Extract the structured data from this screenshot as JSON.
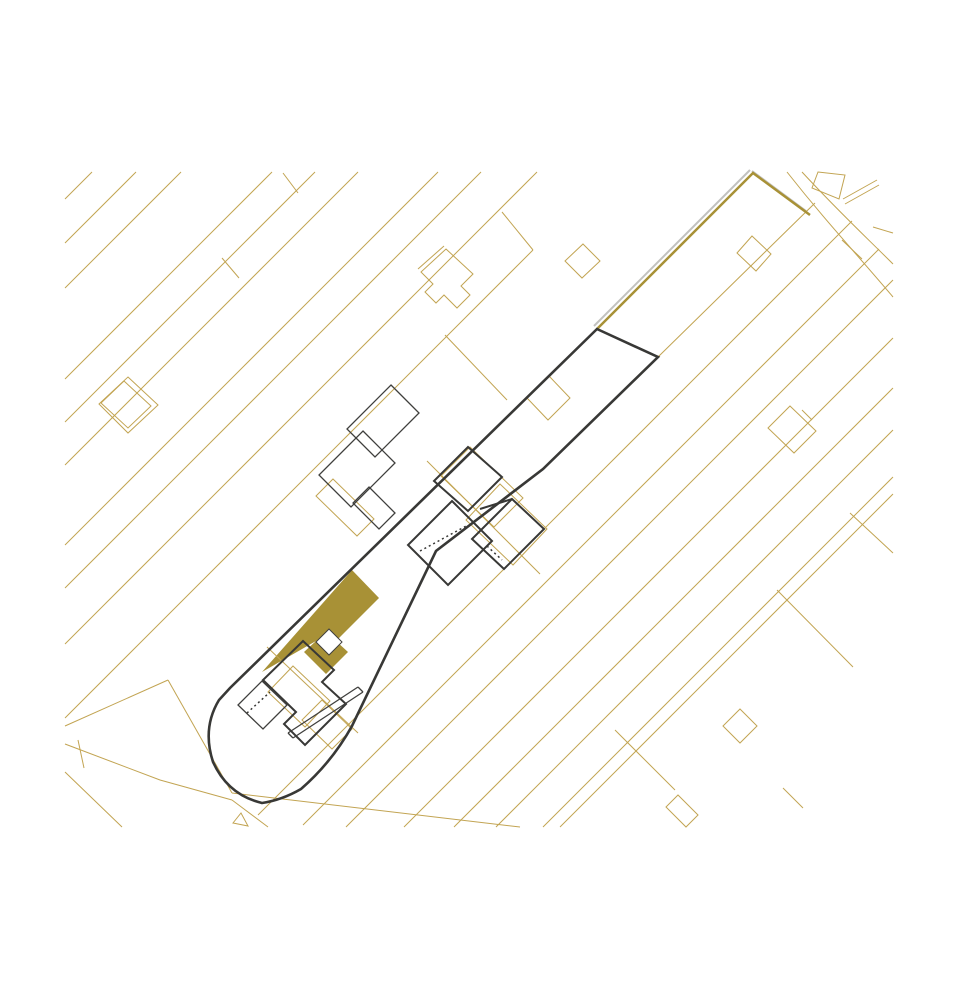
{
  "document": {
    "kind": "architectural-site-plan",
    "description": "Cadastral site plan with diagonal ribbon parcels, black site boundary, existing buildings and gold highlighted new building footprint"
  },
  "drawing": {
    "canvas": {
      "width": 960,
      "height": 1000,
      "background": "#ffffff"
    },
    "clip": {
      "x": 63,
      "y": 168,
      "w": 832,
      "h": 662
    },
    "colors": {
      "gold": "#C2A452",
      "goldDark": "#A89136",
      "fillGold": "#A89136",
      "black": "#383836",
      "thinBlack": "#3F3F3D",
      "shadow": "#8F8F8B",
      "white": "#ffffff"
    },
    "layers": [
      {
        "name": "highlight-building-fill",
        "fill": "fillGold",
        "stroke": "none",
        "width": 0,
        "paths": [
          "M262,672 L352,570 L379,598 L336,641 L348,652 L326,674 L304,652 L316,641 Z"
        ]
      },
      {
        "name": "highlight-notch",
        "fill": "white",
        "stroke": "thinBlack",
        "width": 1,
        "paths": [
          "M329,629 L342,642 L329,655 L316,642 Z"
        ]
      },
      {
        "name": "parcel-lines-upper-left",
        "stroke": "gold",
        "width": 1,
        "paths": [
          "M92,172 L65,199",
          "M136,172 L65,243",
          "M181,172 L65,288",
          "M272,172 L65,379",
          "M315,172 L65,422",
          "M358,172 L65,465",
          "M438,172 L65,545",
          "M481,172 L65,588",
          "M537,172 L65,644",
          "M533,250 L65,718"
        ]
      },
      {
        "name": "parcel-lines-lower-right",
        "stroke": "gold",
        "width": 1,
        "paths": [
          "M852,221 L258,815",
          "M879,249 L303,825",
          "M893,280 L346,827",
          "M893,338 L404,827",
          "M893,388 L454,827",
          "M893,430 L496,827",
          "M893,477 L543,827",
          "M893,494 L560,827"
        ]
      },
      {
        "name": "parcel-cross-connectors",
        "stroke": "gold",
        "width": 1,
        "paths": [
          "M283,173 L298,193",
          "M222,258 L239,278",
          "M502,212 L533,250",
          "M445,335 L507,400",
          "M873,227 L893,233",
          "M850,513 L893,553",
          "M777,590 L853,667",
          "M615,730 L675,790",
          "M783,788 L803,808"
        ]
      },
      {
        "name": "road-fork-bottom-left",
        "stroke": "gold",
        "width": 1,
        "paths": [
          "M65,726 L168,680",
          "M168,680 L232,793",
          "M65,744 L160,780 L232,800",
          "M65,772 L122,827",
          "M78,740 L84,768",
          "M232,793 L520,827",
          "M232,800 L268,827",
          "M233,823 L248,826 L241,813 Z"
        ]
      },
      {
        "name": "road-top-right",
        "stroke": "gold",
        "width": 1,
        "paths": [
          "M787,172 C828,224 855,252 893,297",
          "M802,172 C840,213 865,236 893,264",
          "M818,172 L845,175 L839,199 L812,188 Z",
          "M843,199 L877,180",
          "M845,204 L879,185",
          "M842,240 L862,259",
          "M658,357 L815,203"
        ]
      },
      {
        "name": "neighbor-small-buildings",
        "stroke": "gold",
        "width": 1,
        "paths": [
          "M583,244 L600,261 L582,278 L565,261 Z",
          "M549,376 L570,398 L548,420 L527,398 Z",
          "M752,236 L771,254 L756,271 L737,253 Z",
          "M790,406 L816,431 L794,453 L768,428 Z",
          "M802,410 L812,420",
          "M740,709 L757,726 L740,743 L723,726 Z",
          "M678,795 L698,815 L686,827 L666,807 Z",
          "M128,377 L158,405 L128,433 L99,404 Z",
          "M124,381 L151,406 L128,428 L101,403 Z",
          "M446,249 L473,274 L461,286 L470,295 L457,308 L444,295 L436,303 L425,292 L433,284 L421,272 Z",
          "M418,269 L444,246"
        ]
      },
      {
        "name": "old-footprint-overlays",
        "stroke": "gold",
        "width": 1,
        "paths": [
          "M470,447 L523,498 L494,527 L441,476 Z",
          "M500,484 L547,529 L513,565 L466,520 Z",
          "M427,461 L540,574",
          "M333,479 L374,519 L357,536 L316,496 Z",
          "M267,647 L358,733",
          "M293,666 L330,701 L305,727 L268,692 Z",
          "M322,700 L352,729 L332,749 L302,720 Z"
        ]
      },
      {
        "name": "parcel-shadow",
        "stroke": "shadow",
        "width": 2,
        "opacity": 0.55,
        "paths": [
          "M594,326 L750,170",
          "M752,171 L806,211"
        ]
      },
      {
        "name": "emphasized-parcel-edge",
        "stroke": "goldDark",
        "width": 2.5,
        "paths": [
          "M597,329 L753,173 L810,215"
        ]
      },
      {
        "name": "site-boundary",
        "stroke": "black",
        "width": 2.6,
        "paths": [
          "M597,329 L658,357 L543,469 L436,551 L352,726 Q332,762 301,789 Q282,800 262,803 Q228,795 213,762 Q202,728 219,700 L230,688 Z"
        ]
      },
      {
        "name": "neighbor-building-north",
        "stroke": "thinBlack",
        "width": 1.3,
        "paths": [
          "M391,385 L419,413 L375,457 L347,429 Z",
          "M363,431 L395,463 L351,507 L319,475 Z",
          "M369,487 L395,513 L379,529 L353,503 Z"
        ]
      },
      {
        "name": "existing-building-middle",
        "stroke": "black",
        "width": 2,
        "paths": [
          "M468,447 L502,477 L468,511 L434,481 Z",
          "M512,499 L544,529 L504,569 L472,539 Z",
          "M452,501 L492,541 L448,585 L408,545 Z",
          "M480,509 L512,499"
        ]
      },
      {
        "name": "existing-building-middle-dashed",
        "stroke": "black",
        "width": 1.5,
        "dash": "2 3",
        "paths": [
          "M420,551 L468,525",
          "M487,546 L502,560"
        ]
      },
      {
        "name": "existing-building-south",
        "stroke": "black",
        "width": 2,
        "paths": [
          "M303,641 L334,670 L322,682 L346,704 L305,745 L284,724 L296,712 L263,680 Z"
        ]
      },
      {
        "name": "existing-building-south-annex",
        "stroke": "thinBlack",
        "width": 1.3,
        "paths": [
          "M262,681 L287,705 L263,729 L238,705 Z",
          "M288,733 L358,687",
          "M293,738 L363,692",
          "M358,687 L363,692",
          "M288,733 L293,738"
        ]
      },
      {
        "name": "existing-building-south-dashed",
        "stroke": "black",
        "width": 1.5,
        "dash": "2 3",
        "paths": [
          "M247,713 L270,692"
        ]
      }
    ]
  }
}
